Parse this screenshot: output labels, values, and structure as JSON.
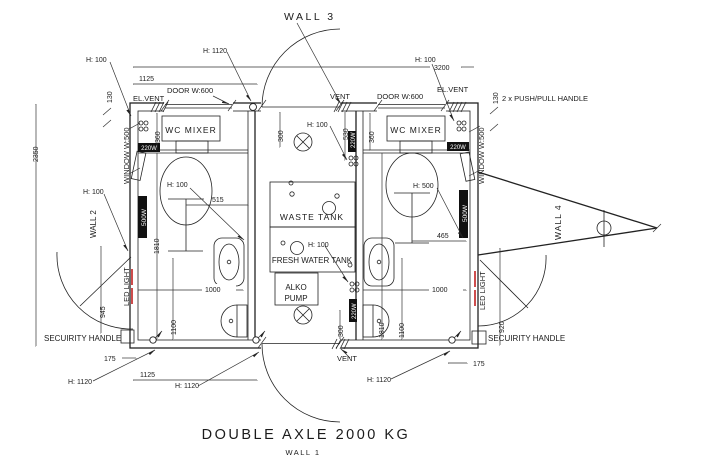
{
  "drawing": {
    "title": "DOUBLE AXLE 2000 KG",
    "walls": {
      "wall1": "WALL 1",
      "wall2": "WALL 2",
      "wall3": "WALL 3",
      "wall4": "WALL 4"
    },
    "rooms": {
      "wc_mixer": "WC MIXER",
      "waste_tank": "WASTE TANK",
      "fresh_water_tank": "FRESH WATER TANK",
      "alko_pump_line1": "ALKO",
      "alko_pump_line2": "PUMP"
    },
    "openings": {
      "door": "DOOR W:600",
      "window": "WINDOW W:500",
      "vent": "VENT",
      "el_vent": "EL.VENT"
    },
    "equipment": {
      "led_light": "LED LIGHT",
      "security_handle": "SECUIRITY HANDLE",
      "push_pull_handle": "2 x PUSH/PULL HANDLE",
      "socket_220w": "220W",
      "heater_500w": "500W"
    },
    "heights": {
      "h100": "H: 100",
      "h500": "H: 500",
      "h1120": "H: 1120"
    },
    "dimensions_mm": {
      "d3200": "3200",
      "d2350": "2350",
      "d1125": "1125",
      "d1810": "1810",
      "d1100": "1100",
      "d1000": "1000",
      "d945": "945",
      "d920": "920",
      "d530": "530",
      "d515": "515",
      "d465": "465",
      "d360": "360",
      "d300": "300",
      "d175": "175",
      "d130": "130"
    },
    "colors": {
      "line": "#222222",
      "led_strip_red": "#c22020",
      "background": "#ffffff"
    }
  }
}
